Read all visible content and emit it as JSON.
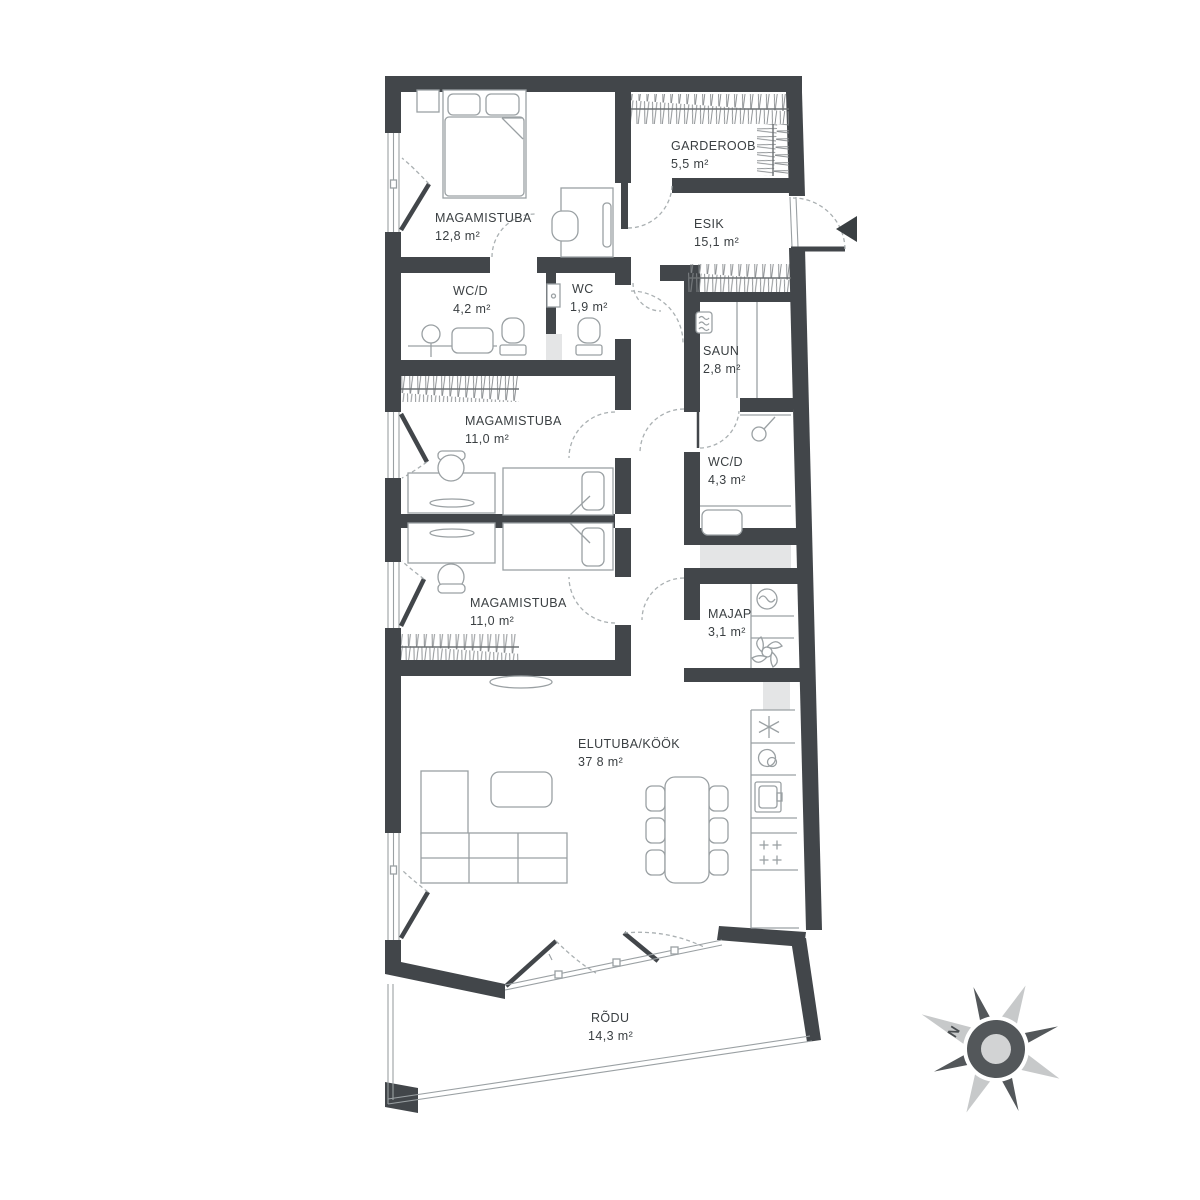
{
  "plan": {
    "title": "apartment-floor-plan",
    "rooms": [
      {
        "id": "magamistuba-1",
        "name": "MAGAMISTUBA",
        "area": "12,8 m²"
      },
      {
        "id": "garderoob",
        "name": "GARDEROOB",
        "area": "5,5 m²"
      },
      {
        "id": "esik",
        "name": "ESIK",
        "area": "15,1 m²"
      },
      {
        "id": "wcd-1",
        "name": "WC/D",
        "area": "4,2 m²"
      },
      {
        "id": "wc",
        "name": "WC",
        "area": "1,9 m²"
      },
      {
        "id": "saun",
        "name": "SAUN",
        "area": "2,8 m²"
      },
      {
        "id": "magamistuba-2",
        "name": "MAGAMISTUBA",
        "area": "11,0 m²"
      },
      {
        "id": "wcd-2",
        "name": "WC/D",
        "area": "4,3 m²"
      },
      {
        "id": "magamistuba-3",
        "name": "MAGAMISTUBA",
        "area": "11,0 m²"
      },
      {
        "id": "majap",
        "name": "MAJAP",
        "area": "3,1 m²"
      },
      {
        "id": "elutuba-kook",
        "name": "ELUTUBA/KÖÖK",
        "area": "37 8 m²"
      },
      {
        "id": "rodu",
        "name": "RÕDU",
        "area": "14,3 m²"
      }
    ],
    "compass": {
      "north_label": "N"
    },
    "icons": [
      "compass-rose-icon",
      "washing-machine-icon",
      "ventilation-fan-icon",
      "freezer-icon",
      "dishwasher-icon",
      "kitchen-sink-icon",
      "stove-icon",
      "sauna-heater-icon",
      "shower-icon",
      "toilet-icon",
      "washbasin-icon",
      "entry-direction-arrow-icon",
      "wardrobe-hatch-icon"
    ],
    "colors": {
      "wall": "#42464a",
      "furniture": "#9aa0a3",
      "hatch": "#85898c",
      "text": "#3a3f42",
      "light_fill": "#e4e5e6",
      "compass_light": "#c7c9ca",
      "compass_dark": "#53575a",
      "background": "#ffffff"
    }
  }
}
